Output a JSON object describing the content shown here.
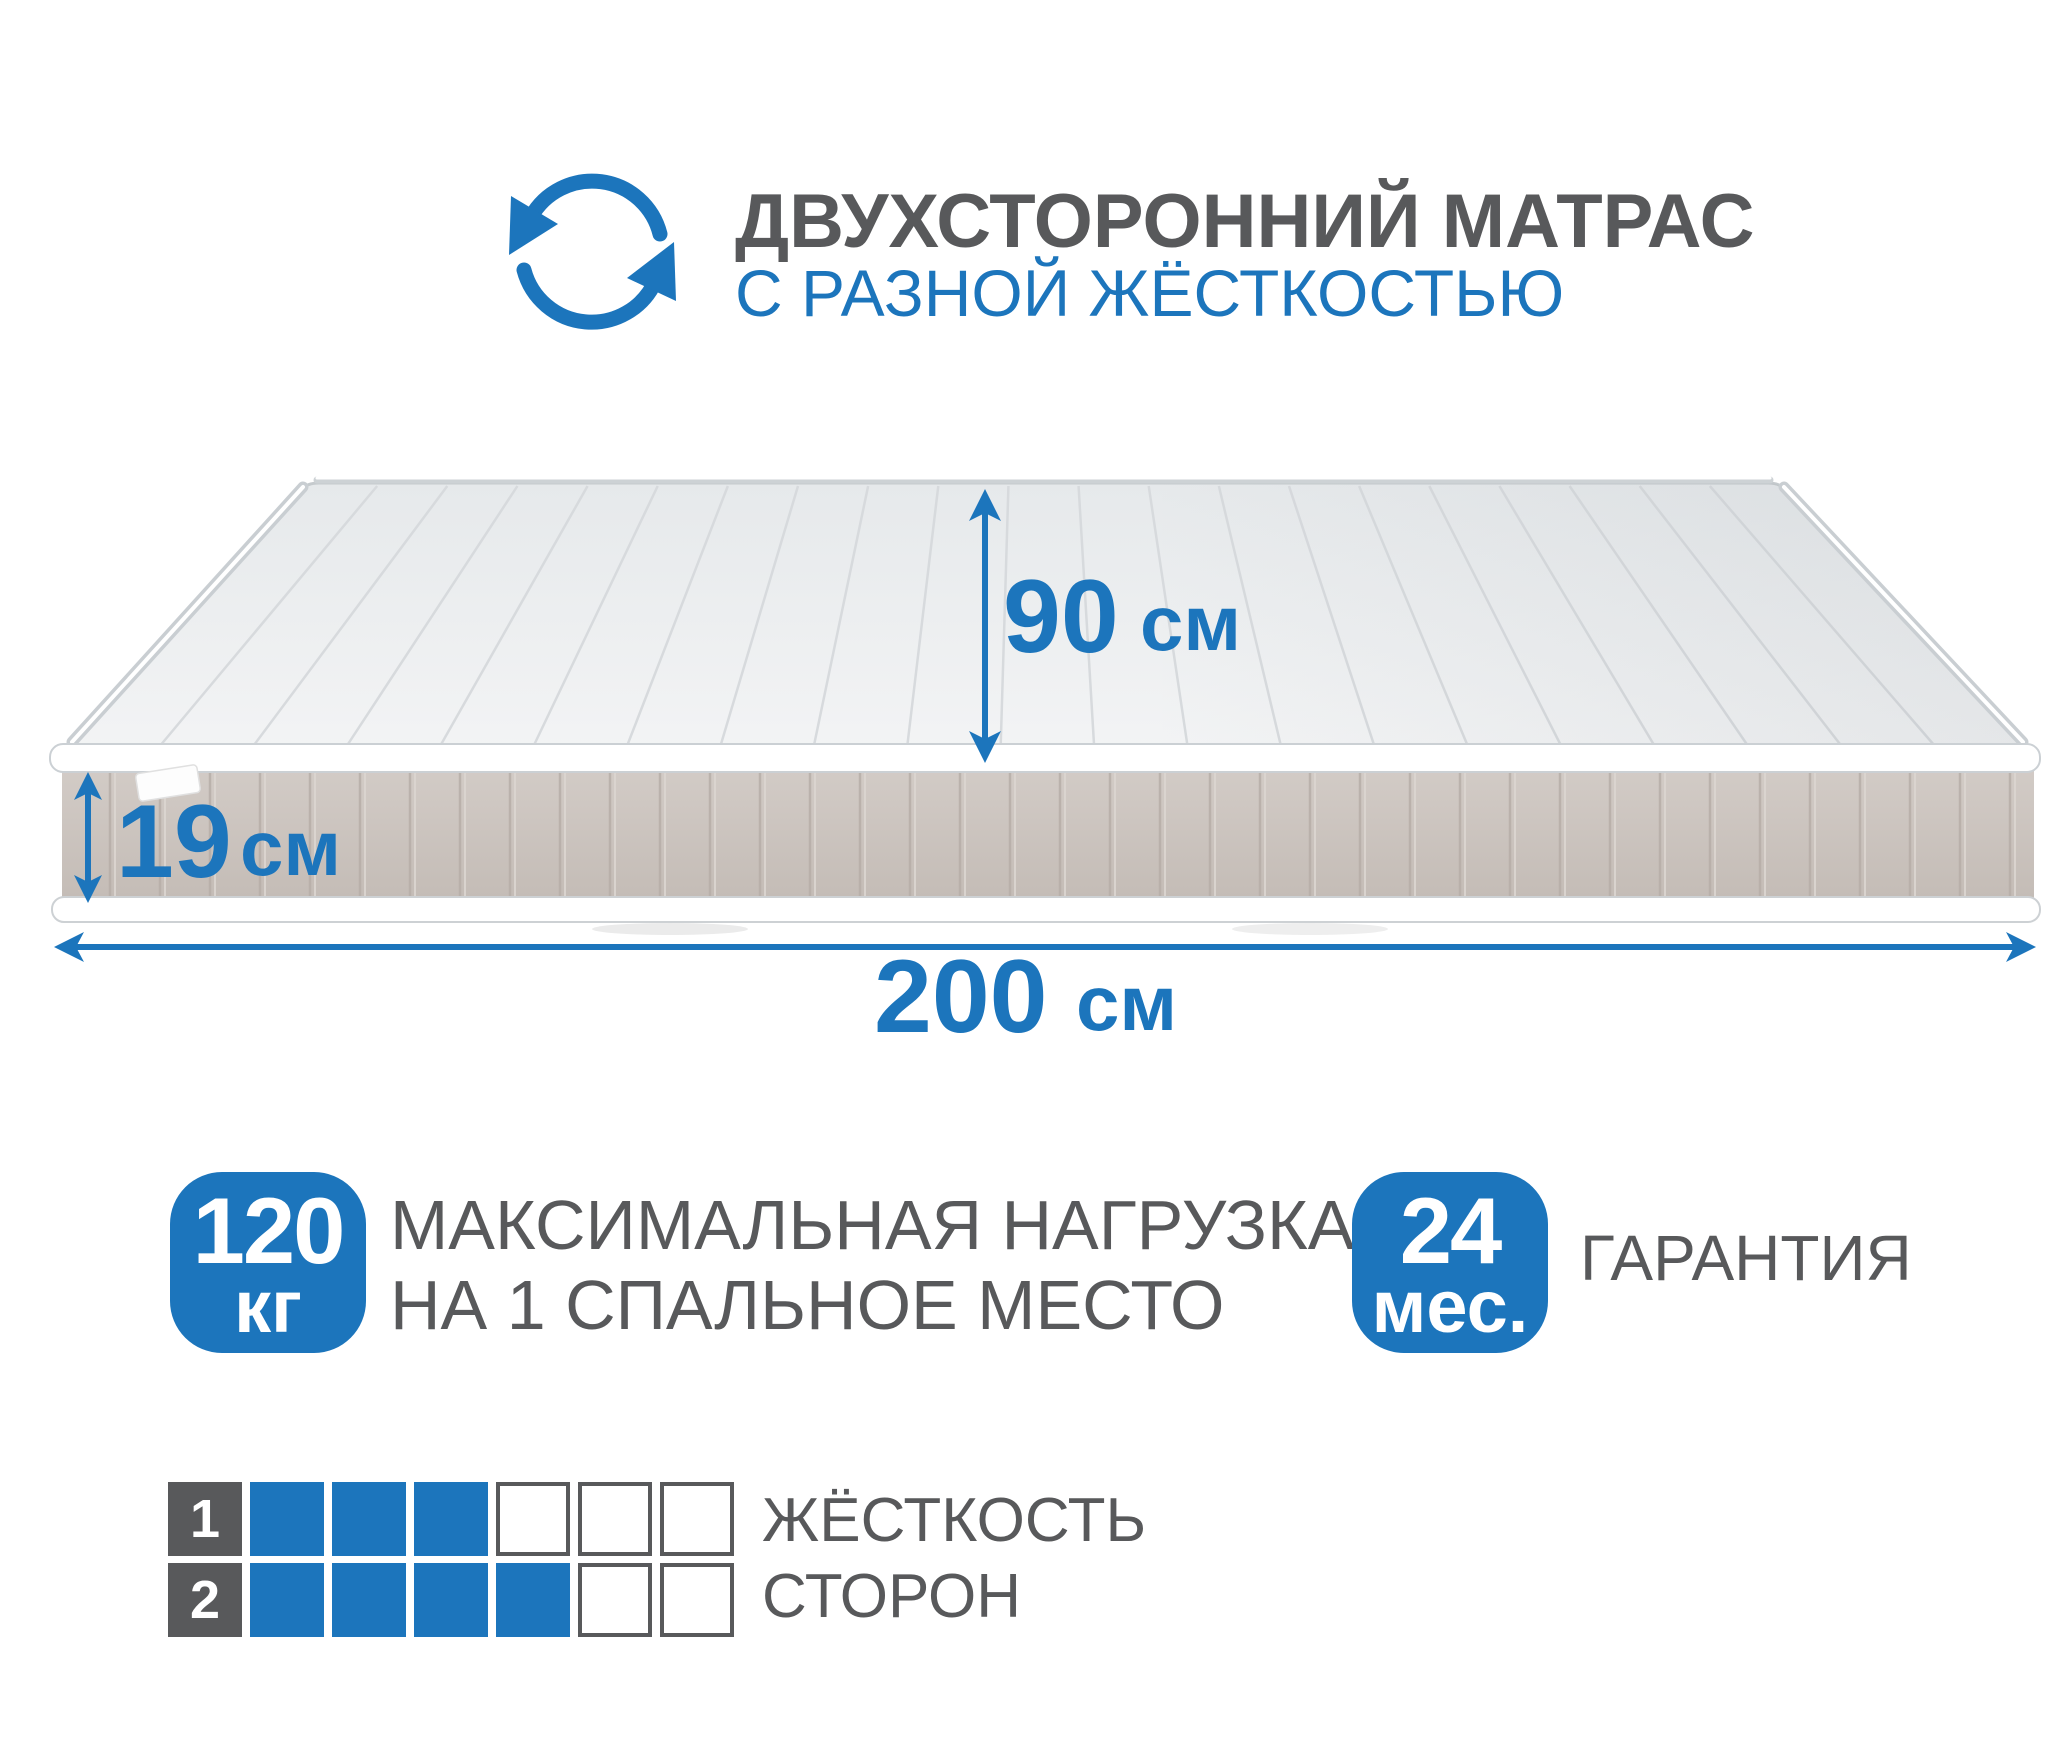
{
  "colors": {
    "accent_blue": "#1C75BC",
    "text_gray": "#58595B",
    "top_surface_light": "#F3F4F5",
    "top_surface_dark": "#E6E9EB",
    "top_stripe": "#D7DADD",
    "side_top": "#D2CBC6",
    "side_bottom": "#C3BBB5",
    "side_stripe_dark": "#B7AEA8",
    "side_stripe_light": "#DCD6D1",
    "piping_white": "#FFFFFF",
    "piping_gray": "#C9CED2"
  },
  "header": {
    "icon": "rotate-arrows-icon",
    "title": "ДВУХСТОРОННИЙ МАТРАС",
    "subtitle": "С РАЗНОЙ ЖЁСТКОСТЬЮ"
  },
  "dimensions": {
    "width": {
      "value": "90",
      "unit": "см"
    },
    "height": {
      "value": "19",
      "unit": "см"
    },
    "length": {
      "value": "200",
      "unit": "см"
    }
  },
  "badges": [
    {
      "value": "120",
      "unit": "кг",
      "label_line1": "МАКСИМАЛЬНАЯ НАГРУЗКА",
      "label_line2": "НА 1 СПАЛЬНОЕ МЕСТО"
    },
    {
      "value": "24",
      "unit": "мес.",
      "label_line1": "ГАРАНТИЯ"
    }
  ],
  "firmness": {
    "label_line1": "ЖЁСТКОСТЬ",
    "label_line2": "СТОРОН",
    "scale_max": 6,
    "rows": [
      {
        "side": "1",
        "filled": 3
      },
      {
        "side": "2",
        "filled": 4
      }
    ]
  }
}
